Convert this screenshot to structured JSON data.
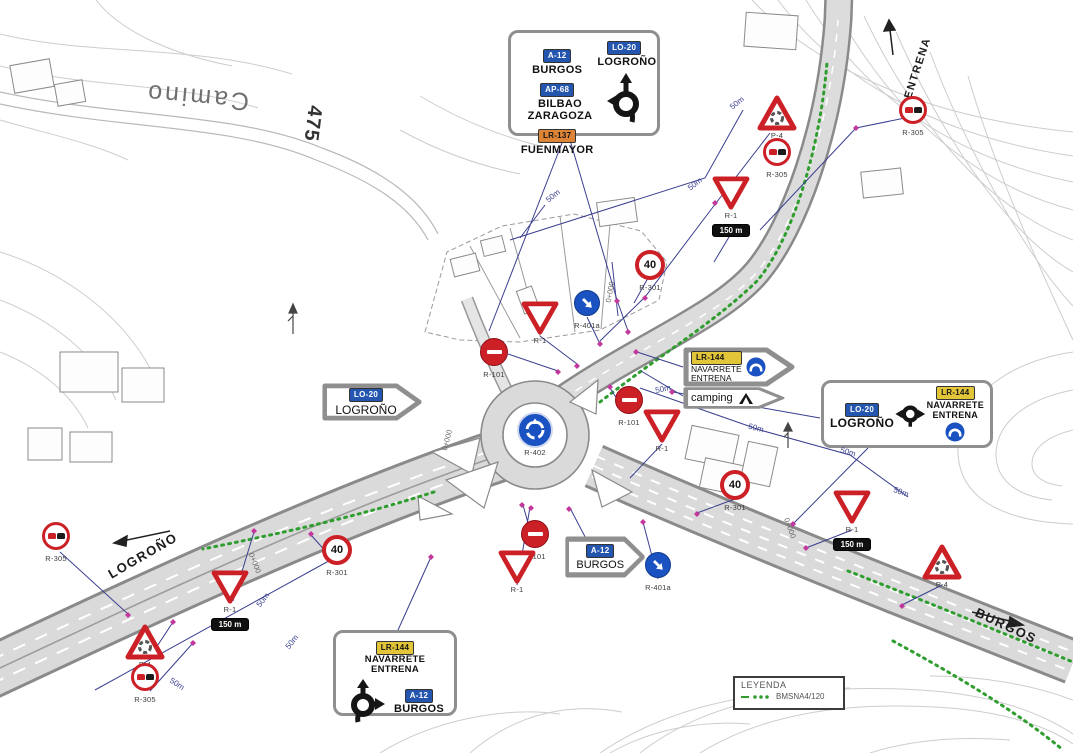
{
  "road_labels": {
    "logrono": "LOGROÑO",
    "burgos": "BURGOS",
    "entrena": "ENTRENA",
    "camino": "Camino",
    "elevation": "475"
  },
  "legend": {
    "title": "LEYENDA",
    "item": "BMSNA4/120"
  },
  "boards": {
    "main": {
      "exit_badge": "LO-20",
      "exit_dest": "LOGROÑO",
      "rows": [
        {
          "badge": "A-12",
          "dest": "BURGOS"
        },
        {
          "badge": "AP-68",
          "dest": "BILBAO ZARAGOZA"
        },
        {
          "badge": "LR-137",
          "dest": "FUENMAYOR"
        }
      ]
    },
    "logrono_arrow": {
      "badge": "LO-20",
      "dest": "LOGROÑO"
    },
    "navarrete_arrow": {
      "badge": "LR-144",
      "dest1": "NAVARRETE",
      "dest2": "ENTRENA"
    },
    "camping_arrow": {
      "label": "camping"
    },
    "right": {
      "badge1": "LO-20",
      "dest1": "LOGROÑO",
      "badge2": "LR-144",
      "dest2": "NAVARRETE",
      "dest3": "ENTRENA"
    },
    "burgos_arrow": {
      "badge": "A-12",
      "dest": "BURGOS"
    },
    "bottom": {
      "badge1": "LR-144",
      "dest1": "NAVARRETE",
      "dest2": "ENTRENA",
      "badge2": "A-12",
      "dest3": "BURGOS"
    }
  },
  "sign_placements": [
    {
      "type": "p4",
      "x": 777,
      "y": 113,
      "label": "P-4"
    },
    {
      "type": "r305",
      "x": 777,
      "y": 152,
      "label": "R-305"
    },
    {
      "type": "r1",
      "x": 731,
      "y": 193,
      "label": "R-1",
      "plate": "150 m"
    },
    {
      "type": "r305",
      "x": 913,
      "y": 110,
      "label": "R-305"
    },
    {
      "type": "r301",
      "x": 650,
      "y": 265,
      "label": "R-301",
      "speed": "40"
    },
    {
      "type": "r401a",
      "x": 587,
      "y": 303,
      "label": "R-401a"
    },
    {
      "type": "r1",
      "x": 540,
      "y": 318,
      "label": "R-1"
    },
    {
      "type": "r101",
      "x": 494,
      "y": 352,
      "label": "R-101"
    },
    {
      "type": "r402",
      "x": 535,
      "y": 430,
      "label": "R-402"
    },
    {
      "type": "r101",
      "x": 629,
      "y": 400,
      "label": "R-101"
    },
    {
      "type": "r1",
      "x": 662,
      "y": 426,
      "label": "R-1"
    },
    {
      "type": "r301",
      "x": 735,
      "y": 485,
      "label": "R-301",
      "speed": "40"
    },
    {
      "type": "r1",
      "x": 852,
      "y": 507,
      "label": "R-1",
      "plate": "150 m"
    },
    {
      "type": "p4",
      "x": 942,
      "y": 562,
      "label": "P-4"
    },
    {
      "type": "r305",
      "x": 56,
      "y": 536,
      "label": "R-305"
    },
    {
      "type": "r301",
      "x": 337,
      "y": 550,
      "label": "R-301",
      "speed": "40"
    },
    {
      "type": "r1",
      "x": 230,
      "y": 587,
      "label": "R-1",
      "plate": "150 m"
    },
    {
      "type": "r101",
      "x": 535,
      "y": 534,
      "label": "R-101"
    },
    {
      "type": "r1",
      "x": 517,
      "y": 567,
      "label": "R-1"
    },
    {
      "type": "r401a",
      "x": 658,
      "y": 565,
      "label": "R-401a"
    },
    {
      "type": "p4",
      "x": 145,
      "y": 642,
      "label": "P-4"
    },
    {
      "type": "r305",
      "x": 145,
      "y": 677,
      "label": "R-305"
    }
  ],
  "measure_labels": [
    {
      "text": "50m",
      "x": 737,
      "y": 103,
      "rot": -40
    },
    {
      "text": "50m",
      "x": 695,
      "y": 184,
      "rot": -38
    },
    {
      "text": "50m",
      "x": 553,
      "y": 196,
      "rot": -40
    },
    {
      "text": "50m",
      "x": 663,
      "y": 389,
      "rot": -12
    },
    {
      "text": "50m",
      "x": 756,
      "y": 428,
      "rot": 14
    },
    {
      "text": "50m",
      "x": 848,
      "y": 452,
      "rot": 16
    },
    {
      "text": "50m",
      "x": 901,
      "y": 492,
      "rot": 20
    },
    {
      "text": "50m",
      "x": 263,
      "y": 600,
      "rot": -52
    },
    {
      "text": "50m",
      "x": 292,
      "y": 642,
      "rot": -52
    },
    {
      "text": "50m",
      "x": 177,
      "y": 684,
      "rot": 33
    }
  ],
  "station_labels": [
    {
      "text": "0+000",
      "x": 610,
      "y": 292,
      "rot": -80
    },
    {
      "text": "0+000",
      "x": 447,
      "y": 440,
      "rot": -75
    },
    {
      "text": "0+000",
      "x": 255,
      "y": 563,
      "rot": 68
    },
    {
      "text": "0+000",
      "x": 790,
      "y": 528,
      "rot": 70
    }
  ],
  "colors": {
    "sign_red": "#cc2027",
    "mandatory_blue": "#1a52c2",
    "badge_blue": "#2456b0",
    "badge_yellow": "#e3c53a",
    "badge_orange": "#dd8436",
    "leader_blue": "#3a3f8f",
    "marker_magenta": "#c2379b",
    "barrier_green": "#2f9e2f"
  }
}
